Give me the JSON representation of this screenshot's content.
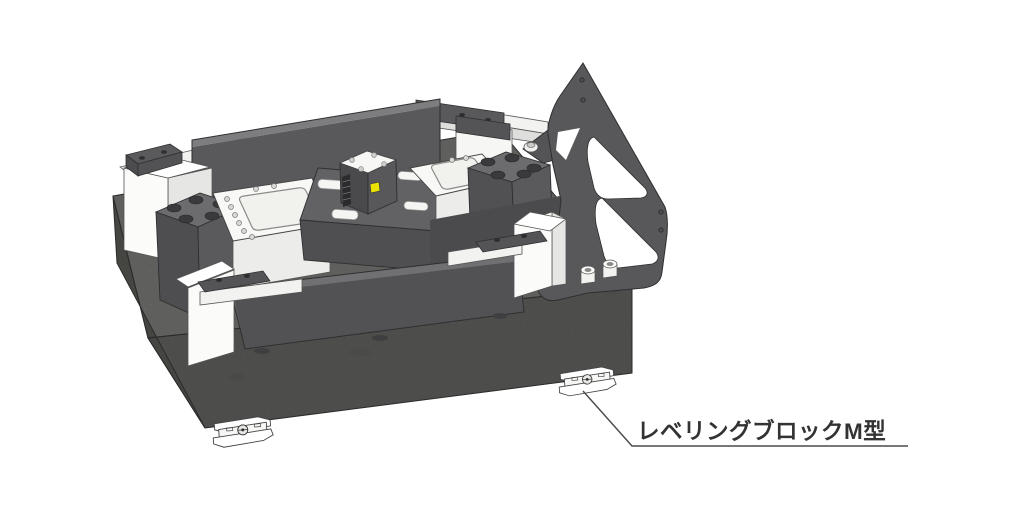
{
  "illustration": {
    "type": "cad-isometric-assembly-diagram",
    "background": "#ffffff",
    "callout": {
      "label": "レベリングブロックM型",
      "text_color": "#333333",
      "leader_color": "#4a4a4a",
      "underline": true
    },
    "colors": {
      "dark_part": "#58585a",
      "dark_part_shadow": "#4f4f51",
      "dark_part_top": "#6c6c6e",
      "panel": "#59595b",
      "bar": "#525254",
      "bracket": "#58585a",
      "white_part": "#fafaf8",
      "white_part_shade": "#ececea",
      "granite_top": "#8f8f8d",
      "granite_front": "#757573",
      "granite_side": "#686866",
      "marker_yellow": "#ece400",
      "outline": "#2f2f31"
    },
    "parts": [
      {
        "id": "granite-surface-plate",
        "desc": "speckled granite base block"
      },
      {
        "id": "leveling-block-left",
        "desc": "leveling block under base, front-left"
      },
      {
        "id": "leveling-block-right",
        "desc": "leveling block under base, pointed by callout"
      },
      {
        "id": "back-panel",
        "desc": "tall dark rear plate"
      },
      {
        "id": "side-bracket",
        "desc": "dark angled bracket with cutouts, right side"
      },
      {
        "id": "counterbore-block-left",
        "desc": "dark block with large counterbore holes"
      },
      {
        "id": "counterbore-block-right",
        "desc": "dark block with large counterbore holes"
      },
      {
        "id": "pocket-plate-left",
        "desc": "white plate with rounded pocket and bolt holes"
      },
      {
        "id": "pocket-plate-right",
        "desc": "white plate with rounded pocket and bolt holes"
      },
      {
        "id": "center-fixture",
        "desc": "dark center fixture with white slots"
      },
      {
        "id": "sensor-cube",
        "desc": "small cube with white drilled top and yellow marker"
      },
      {
        "id": "front-clamp-left",
        "desc": "white clamp block with dark cap"
      },
      {
        "id": "front-clamp-right",
        "desc": "white clamp block with dark cap"
      },
      {
        "id": "rear-rail-left",
        "desc": "white rail with dark end cap"
      },
      {
        "id": "rear-rail-right",
        "desc": "white rail with dark cap"
      },
      {
        "id": "front-bar",
        "desc": "long dark bar on granite top"
      }
    ]
  }
}
